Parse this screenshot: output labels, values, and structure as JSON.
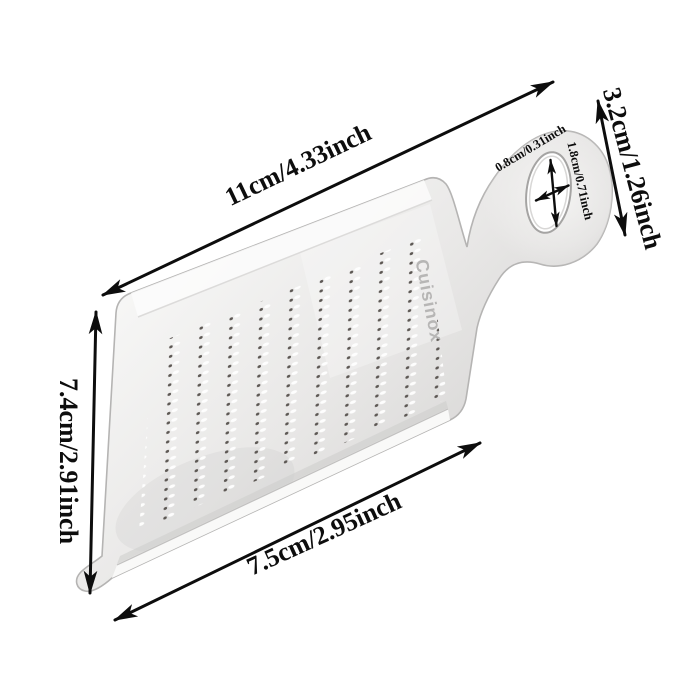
{
  "page": {
    "background": "#ffffff",
    "description_label": "grater-with-dimension-annotations"
  },
  "product": {
    "brand": "Cuisinox",
    "colors": {
      "body_light": "#f7f7f6",
      "body_mid": "#e9e8e7",
      "body_dark": "#cfcecd",
      "edge": "#b5b4b3",
      "brand_text": "#b7b6b5",
      "tooth_dark": "#5d5854"
    }
  },
  "annotation": {
    "color": "#0d0d0d",
    "dimensions": {
      "top_edge": "11cm/4.33inch",
      "handle_end": "3.2cm/1.26inch",
      "left_height": "7.4cm/2.91inch",
      "bottom_edge": "7.5cm/2.95inch",
      "hole_width": "0.8cm/0.31inch",
      "hole_height": "1.8cm/0.71inch"
    }
  }
}
